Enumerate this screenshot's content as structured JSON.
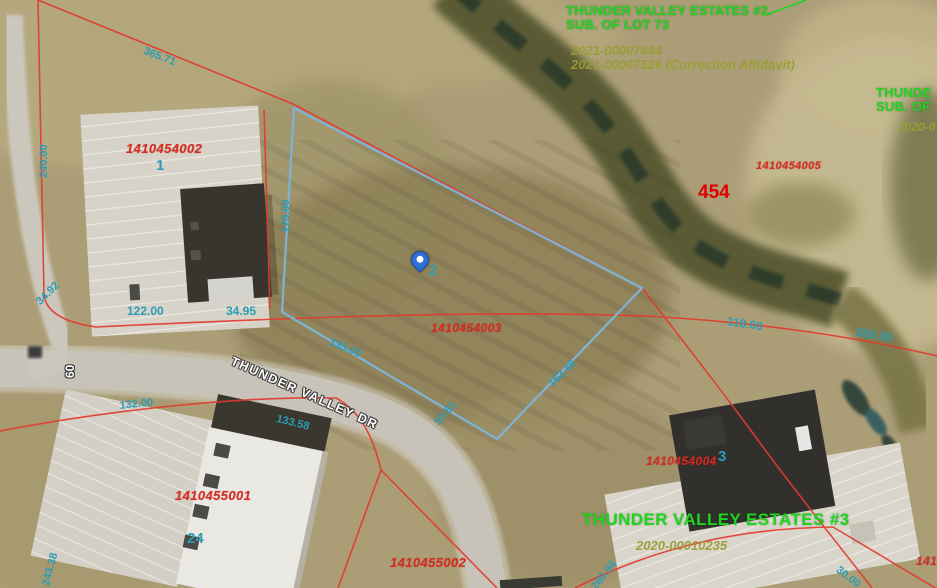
{
  "subdivisions": {
    "tve2_line1": "THUNDER VALLEY ESTATES #2.",
    "tve2_line2": "SUB. OF LOT 73",
    "tve2_doc1": "2021-00007444",
    "tve2_doc2": "2021-00007526 (Correction Affidavit)",
    "edge_line1": "THUNDE",
    "edge_line2": "SUB. OF",
    "edge_doc": "2020-0",
    "tve3_name": "THUNDER VALLEY ESTATES #3",
    "tve3_doc": "2020-00010235"
  },
  "parcels": {
    "p1": {
      "id": "1410454002",
      "lot": "1"
    },
    "p2": {
      "id": "1410454003",
      "lot": "2"
    },
    "p3": {
      "id": "1410454004",
      "lot": "3"
    },
    "p5": {
      "id": "1410454005"
    },
    "p24": {
      "id": "1410455001",
      "lot": "24"
    },
    "p25": {
      "id": "1410455002"
    },
    "lot454": "454",
    "edge_partial_id": "1410"
  },
  "dimensions": {
    "d240": "240.00",
    "d175": "175.00",
    "d122": "122.00",
    "d3495": "34.95",
    "d3492": "34.92",
    "d365": "365.71",
    "d135": "135.00",
    "d5081": "50.81",
    "d162": "162.48",
    "d118": "118.00",
    "d350": "350.00",
    "d132": "132.00",
    "d133": "133.58",
    "d243": "243.38",
    "d280": "280.94",
    "d30": "30.00"
  },
  "road": {
    "name": "THUNDER VALLEY DR",
    "width_label": "60"
  },
  "marker": {
    "lot_label": "2"
  },
  "colors": {
    "parcel_line": "#e23b2e",
    "selected_parcel_outline": "#7fb3d6",
    "dimension_text": "#2d9cb5",
    "parcel_id_text": "#d92b21",
    "subdivision_text": "#1ed41e",
    "document_text": "#9a9d33",
    "highlight_parcel_text": "#e00000",
    "road_label_text": "#ffffff",
    "marker_fill": "#2e6fd4"
  }
}
